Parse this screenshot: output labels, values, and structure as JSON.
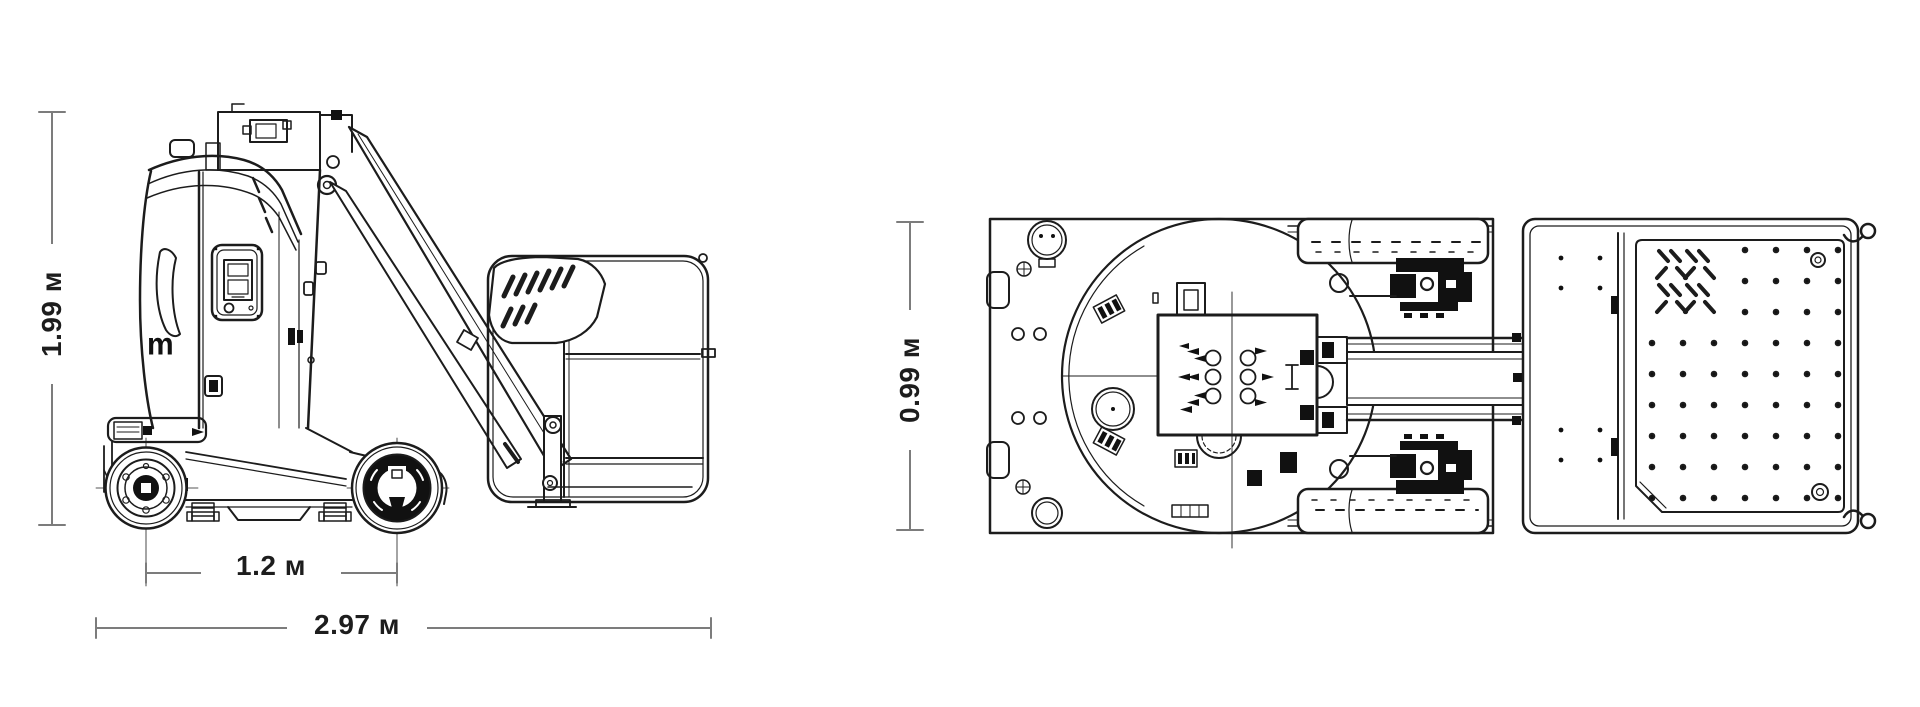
{
  "drawing": {
    "type": "technical-dimension-drawing",
    "colors": {
      "line": "#1c1c1c",
      "dimension": "#7c7c7c",
      "background": "#ffffff"
    },
    "dimensions": {
      "height": {
        "label": "1.99 м",
        "orientation": "vertical",
        "view": "side"
      },
      "wheelbase": {
        "label": "1.2 м",
        "orientation": "horizontal",
        "view": "side"
      },
      "length": {
        "label": "2.97 м",
        "orientation": "horizontal",
        "view": "side"
      },
      "width": {
        "label": "0.99 м",
        "orientation": "vertical",
        "view": "top"
      }
    },
    "side_view": {
      "logo_fragment": "m"
    }
  }
}
